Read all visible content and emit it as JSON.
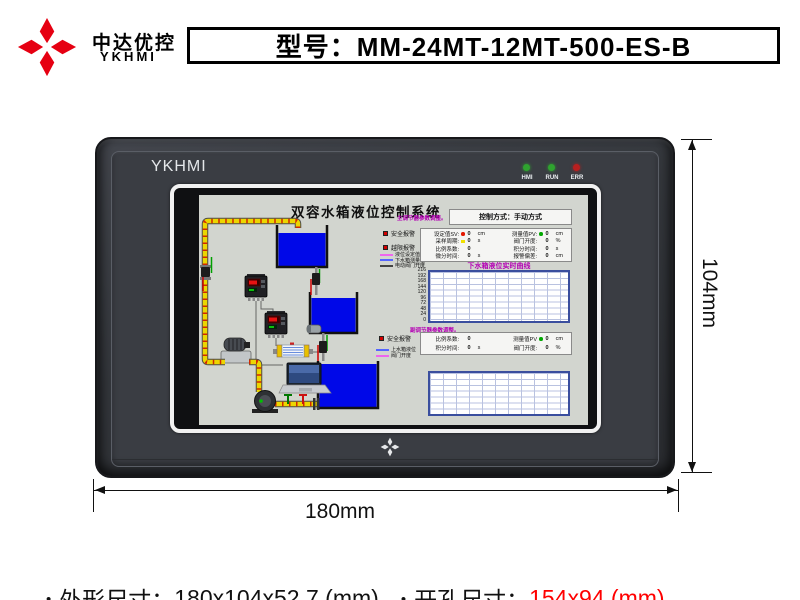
{
  "header": {
    "brand": "中达优控",
    "brand_sub": "YKHMI",
    "model": "型号：MM-24MT-12MT-500-ES-B",
    "logo_color": "#e60012"
  },
  "device": {
    "brand": "YKHMI",
    "leds": [
      {
        "label": "HMI",
        "color": "#2fa32f"
      },
      {
        "label": "RUN",
        "color": "#2fa32f"
      },
      {
        "label": "ERR",
        "color": "#b81f1f"
      }
    ]
  },
  "screen": {
    "title": "双容水箱液位控制系统",
    "control_mode": "控制方式：手动方式",
    "section1_title": "主调节器参数调整。",
    "alarm1": "安全报警",
    "alarm2": "越限报警",
    "legend1": [
      {
        "label": "液位设定值",
        "color": "#ee66ee"
      },
      {
        "label": "下水箱测量值",
        "color": "#5566ff"
      },
      {
        "label": "电动阀门开度",
        "color": "#444444"
      }
    ],
    "pid1": {
      "params": [
        {
          "label": "设定值SV:",
          "value": "0",
          "unit": "cm",
          "dot": "red"
        },
        {
          "label": "测量值PV:",
          "value": "0",
          "unit": "cm",
          "dot": "green"
        },
        {
          "label": "采样周期:",
          "value": "0",
          "unit": "s",
          "dot": "yellow"
        },
        {
          "label": "阀门开度:",
          "value": "0",
          "unit": "%",
          "dot": ""
        },
        {
          "label": "比例系数:",
          "value": "0",
          "unit": "",
          "dot": ""
        },
        {
          "label": "积分时间:",
          "value": "0",
          "unit": "s",
          "dot": ""
        },
        {
          "label": "微分时间:",
          "value": "0",
          "unit": "s",
          "dot": ""
        },
        {
          "label": "报警偏差:",
          "value": "0",
          "unit": "cm",
          "dot": ""
        }
      ]
    },
    "chart1": {
      "title": "下水箱液位实时曲线",
      "y_labels": [
        "216",
        "192",
        "168",
        "144",
        "120",
        "96",
        "72",
        "48",
        "24",
        "0"
      ]
    },
    "section2_title": "副调节器参数调整。",
    "alarm3": "安全报警",
    "legend2": [
      {
        "label": "上水箱液位",
        "color": "#5566ff"
      },
      {
        "label": "阀门开度",
        "color": "#ee66ee"
      }
    ],
    "pid2": {
      "params": [
        {
          "label": "比例系数:",
          "value": "0",
          "unit": "",
          "dot": ""
        },
        {
          "label": "测量值PV",
          "value": "0",
          "unit": "cm",
          "dot": "green"
        },
        {
          "label": "积分时间:",
          "value": "0",
          "unit": "s",
          "dot": ""
        },
        {
          "label": "阀门开度:",
          "value": "0",
          "unit": "%",
          "dot": ""
        }
      ]
    }
  },
  "dimensions": {
    "width_label": "180mm",
    "height_label": "104mm"
  },
  "footer": {
    "bullet": "•",
    "item1_label": "外形尺寸：",
    "item1_value": "180x104x52.7 (mm)",
    "item2_label": "开孔尺寸：",
    "item2_value": "154x94 (mm)",
    "item2_color": "#ff0000"
  }
}
